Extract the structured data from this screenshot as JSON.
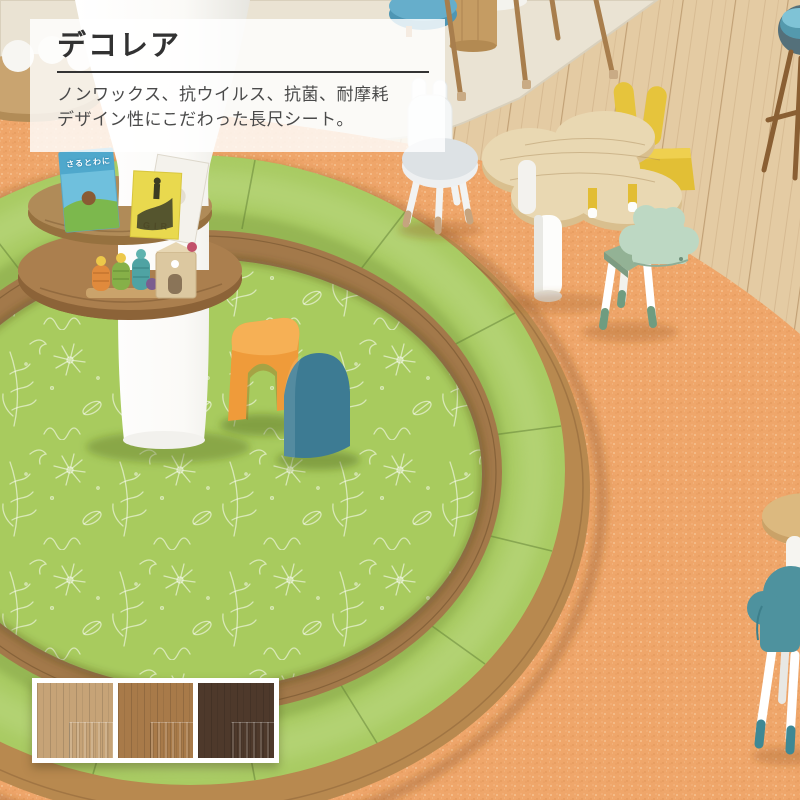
{
  "overlay": {
    "title": "デコレア",
    "description_line1": "ノンワックス、抗ウイルス、抗菌、耐摩耗",
    "description_line2": "デザイン性にこだわった長尺シート。"
  },
  "books": {
    "blue_book_title": "さるとわに",
    "yellow_book_title": "GIR"
  },
  "swatches": {
    "items": [
      {
        "name": "wood-light",
        "color": "#c6a377"
      },
      {
        "name": "wood-medium",
        "color": "#a87a49"
      },
      {
        "name": "wood-dark",
        "color": "#4e392b"
      }
    ]
  },
  "scene_colors": {
    "cork_floor": "#efa66a",
    "wood_floor": "#e4cba3",
    "area_rug": "#eae3d3",
    "mat_green": "#a8cb5e",
    "bench_green": "#a9cb63",
    "bench_wood_rim": "#b8894f",
    "bench_wood_inner": "#a3794a",
    "accent_orange": "#ef9b3a",
    "accent_teal": "#3d7b93"
  }
}
